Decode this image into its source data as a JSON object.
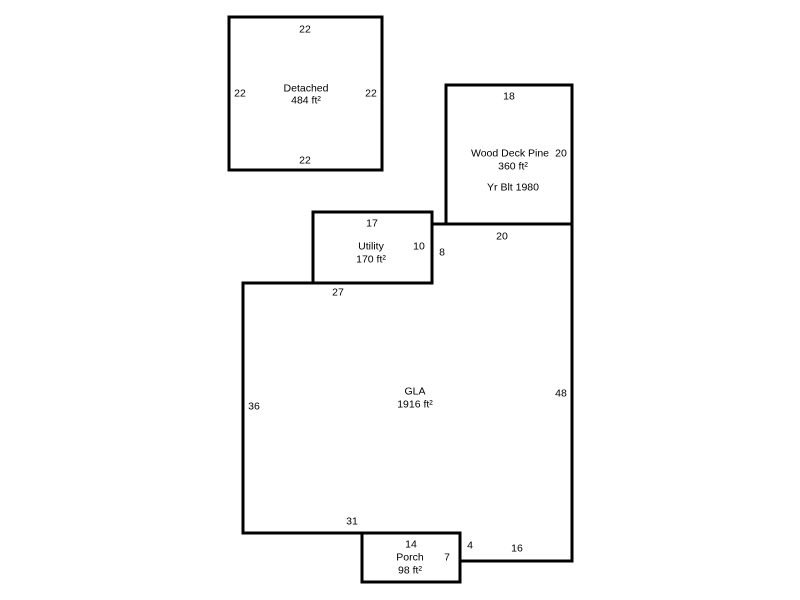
{
  "colors": {
    "line": "#000000",
    "background": "#ffffff",
    "text": "#000000"
  },
  "areas": {
    "detached": {
      "name": "Detached",
      "area": "484 ft²",
      "dim_top": "22",
      "dim_left": "22",
      "dim_right": "22",
      "dim_bottom": "22"
    },
    "wood_deck": {
      "name": "Wood Deck Pine",
      "area": "360 ft²",
      "note": "Yr Blt 1980",
      "dim_top": "18",
      "dim_right": "20"
    },
    "utility": {
      "name": "Utility",
      "area": "170 ft²",
      "dim_top": "17",
      "dim_right": "10"
    },
    "gla": {
      "name": "GLA",
      "area": "1916 ft²",
      "dim_top_left": "27",
      "dim_step_up": "8",
      "dim_top_right": "20",
      "dim_left": "36",
      "dim_right": "48",
      "dim_bottom_left": "31",
      "dim_step_down": "4",
      "dim_bottom_right": "16"
    },
    "porch": {
      "name": "Porch",
      "area": "98 ft²",
      "dim_top": "14",
      "dim_right": "7"
    }
  }
}
